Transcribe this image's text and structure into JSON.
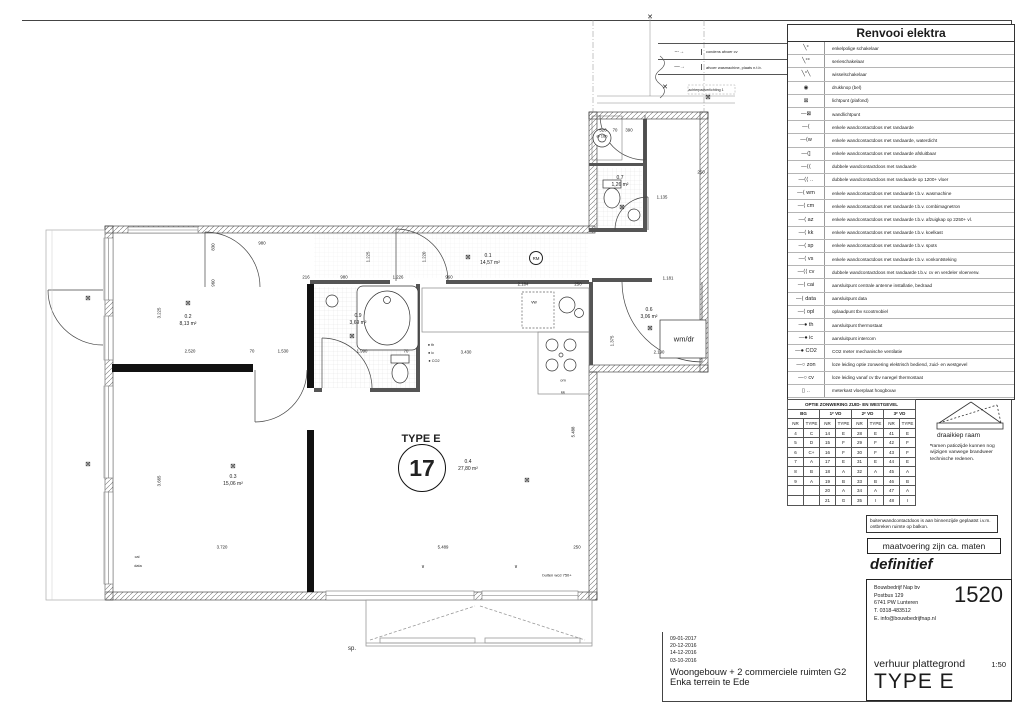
{
  "sheet": {
    "status": "definitief",
    "note_balkon": "buitenwandcontactdoos is aan binnenzijde geplaatst i.v.m. ontbreken ruimte op balkon.",
    "note_maten": "maatvoering zijn ca. maten"
  },
  "legend": {
    "title": "Renvooi elektra",
    "items": [
      {
        "glyph": "╲°",
        "label": "enkelpolige schakelaar"
      },
      {
        "glyph": "╲°°",
        "label": "serieschakelaar"
      },
      {
        "glyph": "╲°╲",
        "label": "wisselschakelaar"
      },
      {
        "glyph": "◉",
        "label": "drukknop (bel)"
      },
      {
        "glyph": "⊠",
        "label": "lichtpunt (plafond)"
      },
      {
        "glyph": "—⊠",
        "label": "wandlichtpunt"
      },
      {
        "glyph": "—⟨",
        "label": "enkele wandcontactdoos met randaarde"
      },
      {
        "glyph": "—⟨w",
        "label": "enkele wandcontactdoos met randaarde, waterdicht"
      },
      {
        "glyph": "—⟨]",
        "label": "enkele wandcontactdoos met randaarde afsluitbaar"
      },
      {
        "glyph": "—⟨⟨",
        "label": "dubbele wandcontactdoos met randaarde"
      },
      {
        "glyph": "—⟨⟨ ‥",
        "label": "dubbele wandcontactdoos met randaarde op 1200+ vloer"
      },
      {
        "glyph": "—⟨ wm",
        "label": "enkele wandcontactdoos met randaarde t.b.v. wasmachine"
      },
      {
        "glyph": "—⟨ cm",
        "label": "enkele wandcontactdoos met randaarde t.b.v. combimagnetron"
      },
      {
        "glyph": "—⟨ az",
        "label": "enkele wandcontactdoos met randaarde t.b.v. afzuigkap op 2250+ vl."
      },
      {
        "glyph": "—⟨ kk",
        "label": "enkele wandcontactdoos met randaarde t.b.v. koelkast"
      },
      {
        "glyph": "—⟨ sp",
        "label": "enkele wandcontactdoos met randaarde t.b.v. spots"
      },
      {
        "glyph": "—⟨ vs",
        "label": "enkele wandcontactdoos met randaarde t.b.v. vonkontsteking"
      },
      {
        "glyph": "—⟨⟨ cv",
        "label": "dubbele wandcontactdoos met randaarde t.b.v. cv en verdeler vloerverw."
      },
      {
        "glyph": "—⟨ cai",
        "label": "aansluitpunt centrale antenne installatie, bedraad"
      },
      {
        "glyph": "—⟨ data",
        "label": "aansluitpunt data"
      },
      {
        "glyph": "—⟨ opl",
        "label": "oplaadpunt tbv scootmobiel"
      },
      {
        "glyph": "—● th",
        "label": "aansluitpunt thermostaat"
      },
      {
        "glyph": "—● ic",
        "label": "aansluitpunt intercom"
      },
      {
        "glyph": "—● CO2",
        "label": "CO2 meter mechanische ventilatie"
      },
      {
        "glyph": "—○ zon",
        "label": "loze leiding optie zonwering elektrisch bediend, zuid- en westgevel"
      },
      {
        "glyph": "—○ cv",
        "label": "loze leiding vanaf cv tbv naregel thermostaat"
      },
      {
        "glyph": "▯ ‥",
        "label": "meterkast vloerplaat hoogbouw"
      }
    ]
  },
  "drain_legend": {
    "items": [
      {
        "glyph": "–·→",
        "label": "condens afvoer cv"
      },
      {
        "glyph": "––→",
        "label": "afvoer wasmachine, plaats n.t.b."
      }
    ]
  },
  "zonwering": {
    "title": "OPTIE ZONWERING ZUID- EN WESTGEVEL",
    "groups": [
      "BG",
      "1ᵉ VD",
      "2ᵉ VD",
      "3ᵉ VD"
    ],
    "subheaders": [
      "NR",
      "TYPE"
    ],
    "rows": [
      [
        "4",
        "C",
        "14",
        "E",
        "28",
        "E",
        "41",
        "E"
      ],
      [
        "5",
        "D",
        "15",
        "F",
        "29",
        "F",
        "42",
        "F"
      ],
      [
        "6",
        "C+",
        "16",
        "F",
        "30",
        "F",
        "43",
        "F"
      ],
      [
        "7",
        "A",
        "17",
        "E",
        "31",
        "E",
        "44",
        "E"
      ],
      [
        "8",
        "B",
        "18",
        "A",
        "32",
        "A",
        "45",
        "A"
      ],
      [
        "9",
        "A",
        "19",
        "B",
        "33",
        "B",
        "46",
        "B"
      ],
      [
        "",
        "",
        "20",
        "A",
        "34",
        "A",
        "47",
        "A"
      ],
      [
        "",
        "",
        "21",
        "G",
        "35",
        "I",
        "48",
        "I"
      ]
    ],
    "window_label": "draaikiep raam",
    "note_marker": "*",
    "note": "ramen patiozijde kunnen nog wijzigen vanwege brandweer technische redenen."
  },
  "titleblock": {
    "company": [
      "Bouwbedrijf Nap bv",
      "Postbus 129",
      "6741 PW Lunteren",
      "T. 0318-483512",
      "E. info@bouwbedrijfnap.nl"
    ],
    "project_number": "1520",
    "doc_type": "verhuur plattegrond",
    "scale": "1:50",
    "type_label": "TYPE E"
  },
  "project": {
    "dates": [
      "09-01-2017",
      "20-12-2016",
      "14-12-2016",
      "03-10-2016"
    ],
    "name": "Woongebouw + 2 commerciele ruimten G2",
    "location": "Enka terrein te Ede"
  },
  "plan": {
    "type_title": "TYPE E",
    "unit_number": "17",
    "labels": [
      {
        "t": "830",
        "x": 213,
        "y": 247,
        "r": 1
      },
      {
        "t": "960",
        "x": 213,
        "y": 283,
        "r": 1
      },
      {
        "t": "980",
        "x": 262,
        "y": 243
      },
      {
        "t": "3.225",
        "x": 159,
        "y": 313,
        "r": 1
      },
      {
        "t": "3.665",
        "x": 159,
        "y": 481,
        "r": 1
      },
      {
        "t": "2.520",
        "x": 190,
        "y": 351
      },
      {
        "t": "70",
        "x": 252,
        "y": 351
      },
      {
        "t": "1.530",
        "x": 283,
        "y": 351
      },
      {
        "t": "1.990",
        "x": 362,
        "y": 351
      },
      {
        "t": "70",
        "x": 406,
        "y": 351
      },
      {
        "t": "3.430",
        "x": 466,
        "y": 352
      },
      {
        "t": "216",
        "x": 306,
        "y": 277
      },
      {
        "t": "980",
        "x": 344,
        "y": 277
      },
      {
        "t": "1.226",
        "x": 398,
        "y": 277
      },
      {
        "t": "960",
        "x": 449,
        "y": 277
      },
      {
        "t": "2.184",
        "x": 523,
        "y": 284
      },
      {
        "t": "250",
        "x": 578,
        "y": 284
      },
      {
        "t": "1.220",
        "x": 424,
        "y": 257,
        "r": 1
      },
      {
        "t": "1.225",
        "x": 368,
        "y": 257,
        "r": 1
      },
      {
        "t": "5.488",
        "x": 573,
        "y": 432,
        "r": 1
      },
      {
        "t": "1.375",
        "x": 612,
        "y": 341,
        "r": 1
      },
      {
        "t": "2.190",
        "x": 659,
        "y": 352
      },
      {
        "t": "1.181",
        "x": 668,
        "y": 278
      },
      {
        "t": "1.135",
        "x": 662,
        "y": 197
      },
      {
        "t": "250",
        "x": 701,
        "y": 172
      },
      {
        "t": "520",
        "x": 603,
        "y": 130
      },
      {
        "t": "70",
        "x": 615,
        "y": 130
      },
      {
        "t": "390",
        "x": 629,
        "y": 130
      },
      {
        "t": "3.720",
        "x": 222,
        "y": 547
      },
      {
        "t": "5.489",
        "x": 443,
        "y": 547
      },
      {
        "t": "250",
        "x": 577,
        "y": 547
      },
      {
        "t": "0.1",
        "x": 488,
        "y": 256,
        "s": 5
      },
      {
        "t": "14,57 m²",
        "x": 490,
        "y": 263,
        "s": 5
      },
      {
        "t": "0.2",
        "x": 188,
        "y": 317,
        "s": 5
      },
      {
        "t": "8,13 m²",
        "x": 188,
        "y": 324,
        "s": 5
      },
      {
        "t": "0.3",
        "x": 233,
        "y": 477,
        "s": 5
      },
      {
        "t": "15,06 m²",
        "x": 233,
        "y": 484,
        "s": 5
      },
      {
        "t": "0.4",
        "x": 468,
        "y": 462,
        "s": 5
      },
      {
        "t": "27,80 m²",
        "x": 468,
        "y": 469,
        "s": 5
      },
      {
        "t": "0.6",
        "x": 649,
        "y": 310,
        "s": 5
      },
      {
        "t": "3,06 m²",
        "x": 649,
        "y": 317,
        "s": 5
      },
      {
        "t": "0.7",
        "x": 620,
        "y": 178,
        "s": 5
      },
      {
        "t": "1,26 m²",
        "x": 620,
        "y": 185,
        "s": 5
      },
      {
        "t": "0.9",
        "x": 358,
        "y": 316,
        "s": 5
      },
      {
        "t": "3,69 m²",
        "x": 358,
        "y": 323,
        "s": 5
      },
      {
        "t": "TYPE E",
        "x": 421,
        "y": 439,
        "s": 11,
        "b": 1
      },
      {
        "t": "17",
        "x": 422,
        "y": 468,
        "c": "bigcirc"
      },
      {
        "t": "RM",
        "x": 536,
        "y": 258,
        "c": "circ"
      },
      {
        "t": "wm/dr",
        "x": 684,
        "y": 339,
        "s": 7.5
      },
      {
        "t": "om",
        "x": 563,
        "y": 380,
        "s": 4
      },
      {
        "t": "kk",
        "x": 563,
        "y": 392,
        "s": 4
      },
      {
        "t": "vw",
        "x": 534,
        "y": 302,
        "s": 4.5
      },
      {
        "t": "sp.",
        "x": 352,
        "y": 649,
        "s": 6
      },
      {
        "t": "buiten wcd 750+",
        "x": 557,
        "y": 575,
        "s": 4
      },
      {
        "t": "Ø 160",
        "x": 602,
        "y": 136,
        "s": 4
      },
      {
        "t": "cai",
        "x": 137,
        "y": 557,
        "s": 3.8
      },
      {
        "t": "data",
        "x": 138,
        "y": 566,
        "s": 3.8
      },
      {
        "t": "achterpadverlichting 1",
        "x": 706,
        "y": 90,
        "s": 3.6
      },
      {
        "t": "✕",
        "x": 665,
        "y": 87,
        "s": 7
      },
      {
        "t": "✕",
        "x": 650,
        "y": 17,
        "s": 7
      },
      {
        "t": "∨",
        "x": 423,
        "y": 567,
        "s": 5
      },
      {
        "t": "∨",
        "x": 516,
        "y": 567,
        "s": 5
      },
      {
        "t": "● th",
        "x": 431,
        "y": 345,
        "s": 3.8
      },
      {
        "t": "● ic",
        "x": 431,
        "y": 353,
        "s": 3.8
      },
      {
        "t": "● CO2",
        "x": 434,
        "y": 361,
        "s": 3.8
      },
      {
        "t": "⊠",
        "x": 468,
        "y": 257,
        "c": "sym"
      },
      {
        "t": "⊠",
        "x": 188,
        "y": 303,
        "c": "sym"
      },
      {
        "t": "⊠",
        "x": 233,
        "y": 466,
        "c": "sym"
      },
      {
        "t": "⊠",
        "x": 352,
        "y": 336,
        "c": "sym"
      },
      {
        "t": "⊠",
        "x": 650,
        "y": 328,
        "c": "sym"
      },
      {
        "t": "⊠",
        "x": 622,
        "y": 207,
        "c": "sym"
      },
      {
        "t": "⊠",
        "x": 88,
        "y": 298,
        "c": "sym"
      },
      {
        "t": "⊠",
        "x": 88,
        "y": 464,
        "c": "sym"
      },
      {
        "t": "⊠",
        "x": 708,
        "y": 97,
        "c": "sym"
      },
      {
        "t": "⊠",
        "x": 527,
        "y": 480,
        "c": "sym"
      }
    ]
  }
}
